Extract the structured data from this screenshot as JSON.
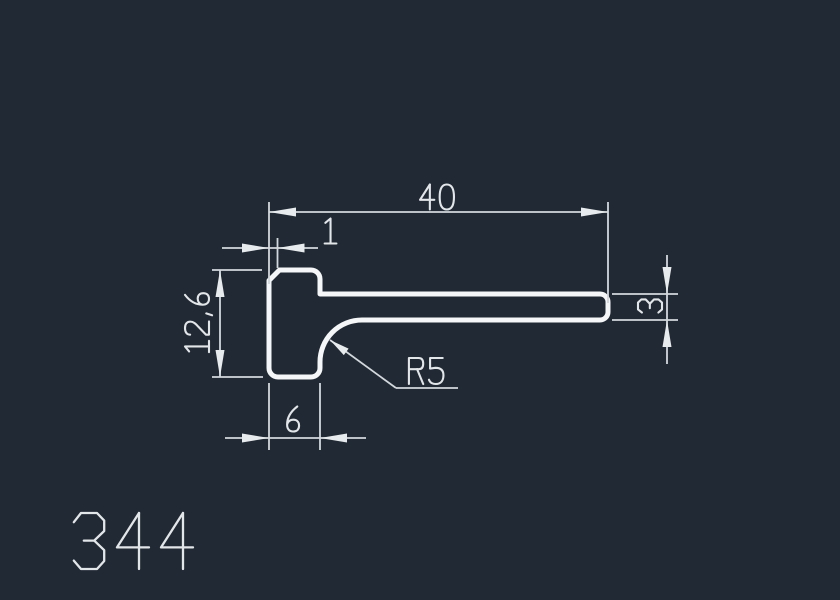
{
  "drawing": {
    "type": "cad-profile-cross-section",
    "part_number": "344",
    "units_note": "mm",
    "dimensions": {
      "total_width": {
        "label": "40",
        "meaning": "overall horizontal length of profile"
      },
      "chamfer": {
        "label": "1",
        "meaning": "small offset at top-left corner"
      },
      "total_height": {
        "label": "12,6",
        "meaning": "overall height of foot, vertical dimension"
      },
      "arm_thickness": {
        "label": "3",
        "meaning": "thickness of horizontal arm at right end"
      },
      "foot_width": {
        "label": "6",
        "meaning": "width of vertical foot at bottom"
      },
      "fillet_radius": {
        "label": "R5",
        "meaning": "inside fillet radius between arm and foot"
      }
    },
    "colors": {
      "background": "#212934",
      "profile_line": "#f4f6f7",
      "dimension_line": "#d3d8dc",
      "arrow_fill": "#e8ebed",
      "text": "#e2e6e9"
    }
  }
}
